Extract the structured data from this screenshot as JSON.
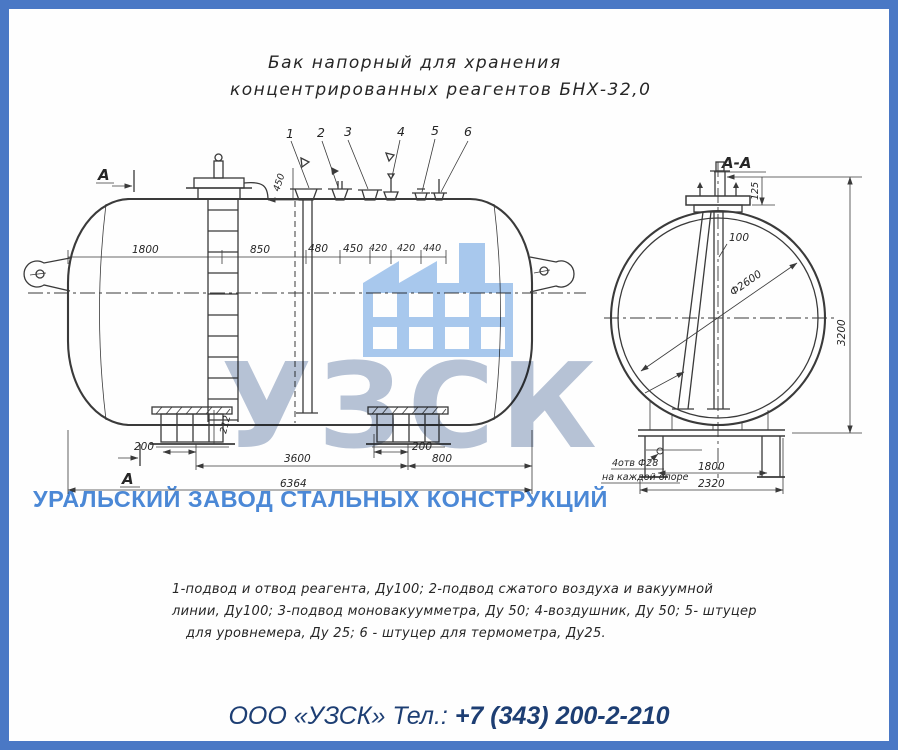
{
  "title": {
    "line1": "Бак напорный для хранения",
    "line2": "концентрированных реагентов БНХ-32,0"
  },
  "main_view": {
    "section_label_top": "А",
    "section_label_bottom": "А",
    "callouts": [
      "1",
      "2",
      "3",
      "4",
      "5",
      "6"
    ],
    "dims": {
      "d1800": "1800",
      "d850": "850",
      "d480": "480",
      "d450": "450",
      "d420a": "420",
      "d420b": "420",
      "d440": "440",
      "riser": "450",
      "support_height": "212",
      "left_offset": "200",
      "center_offset": "200",
      "between_supports": "3600",
      "right_span": "800",
      "overall": "6364"
    }
  },
  "section_view": {
    "title": "А-А",
    "dims": {
      "pipe": "100",
      "neck": "125",
      "diameter": "Ф2600",
      "height": "3200",
      "supports": "1800",
      "base": "2320"
    },
    "note_line1": "4отв Ф28",
    "note_line2": "на каждой опоре"
  },
  "notes": {
    "line1": "1-подвод и отвод реагента, Ду100;  2-подвод сжатого воздуха и вакуумной",
    "line2": "линии, Ду100;  3-подвод моновакуумметра, Ду 50;   4-воздушник, Ду 50;  5- штуцер",
    "line3": "для  уровнемера, Ду 25; 6 - штуцер для  термометра, Ду25."
  },
  "watermark": {
    "logo": "УЗСК",
    "company": "УРАЛЬСКИЙ ЗАВОД СТАЛЬНЫХ КОНСТРУКЦИЙ",
    "logo_color": "#b7c3d6",
    "company_color": "#4b89d7",
    "icon_color": "#a9c9ee"
  },
  "footer": {
    "company": "ООО «УЗСК»",
    "phone_label": "Тел.:",
    "phone": "+7 (343) 200-2-210"
  },
  "frame": {
    "border_color": "#4a78c5"
  }
}
